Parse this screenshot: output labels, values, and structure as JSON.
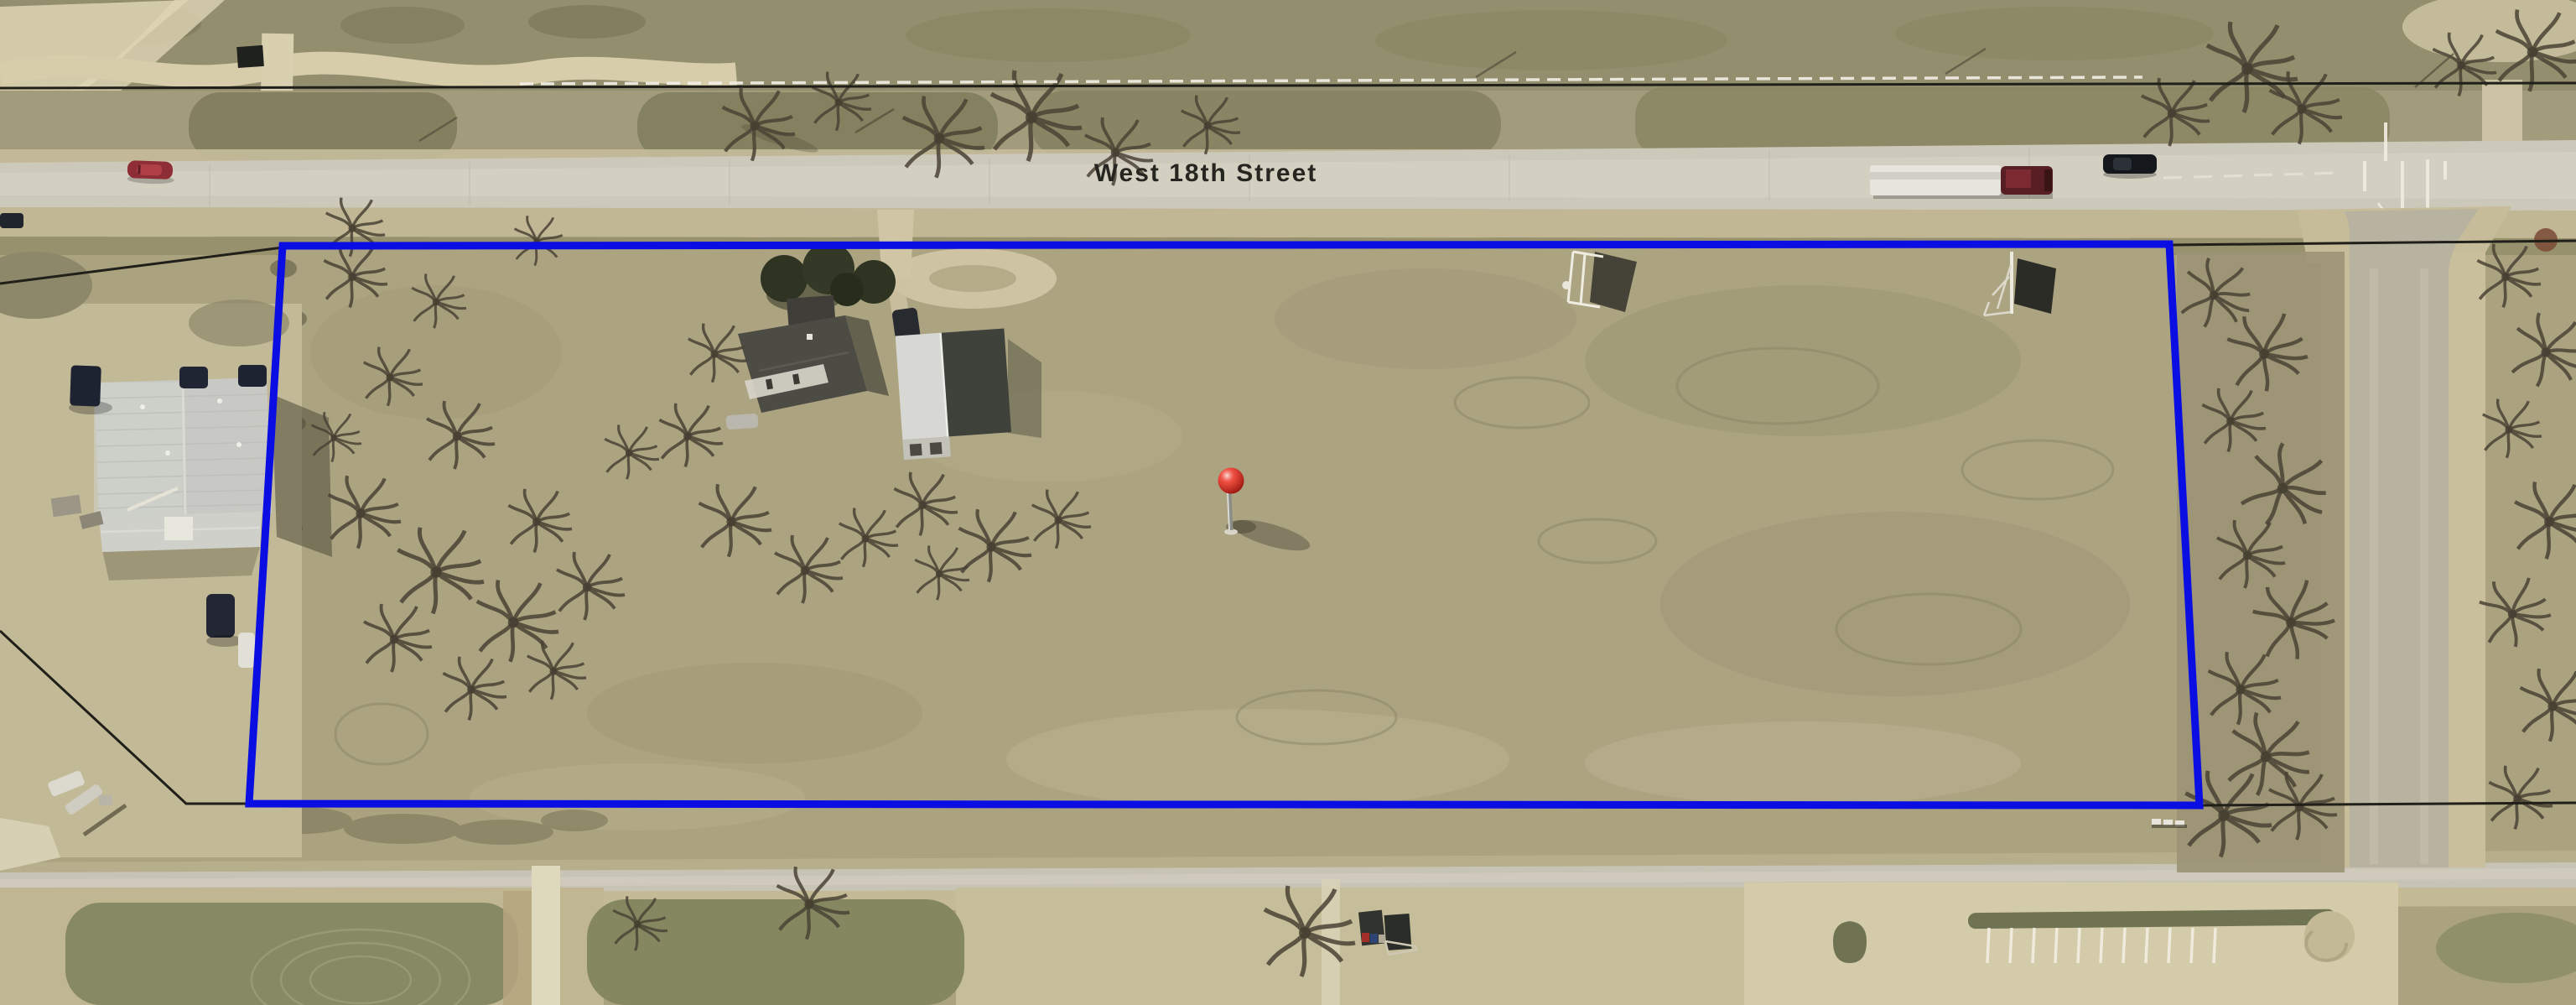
{
  "map": {
    "view": "aerial-oblique",
    "street_label": "West 18th Street",
    "pin": {
      "name": "location-pin"
    }
  },
  "theme": {
    "parcel_blue": "#0b0ee2",
    "survey_black": "#201f19",
    "pin_red": "#df2418",
    "label_color": "#26251f"
  }
}
